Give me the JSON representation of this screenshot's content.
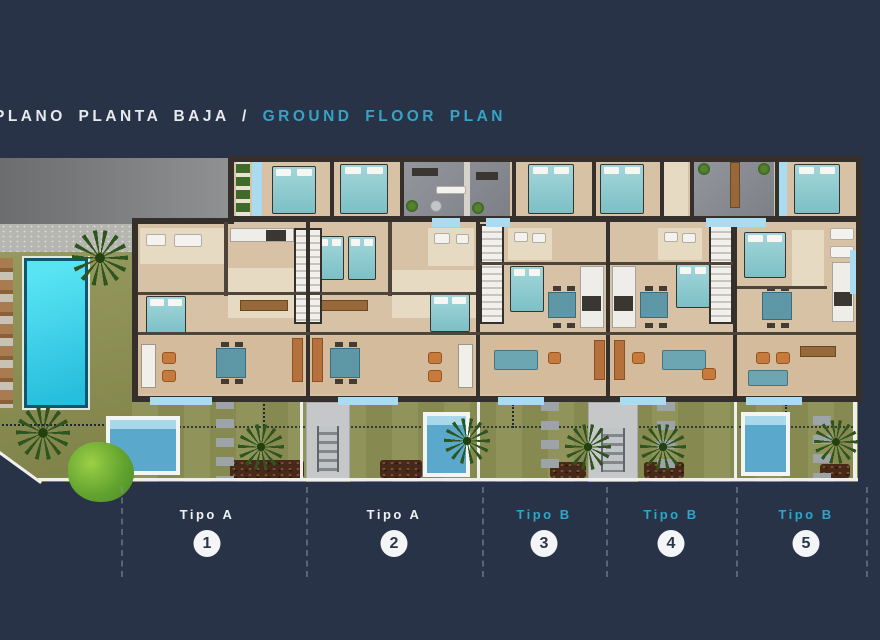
{
  "title": {
    "main": "PLANO PLANTA BAJA",
    "divider": "/",
    "sub": "GROUND FLOOR PLAN"
  },
  "units": [
    {
      "type_label": "Tipo A",
      "number": "1",
      "label_color": "#eef1f4",
      "private_pool": true
    },
    {
      "type_label": "Tipo A",
      "number": "2",
      "label_color": "#eef1f4",
      "private_pool": true
    },
    {
      "type_label": "Tipo B",
      "number": "3",
      "label_color": "#2ba7cb",
      "private_pool": false
    },
    {
      "type_label": "Tipo B",
      "number": "4",
      "label_color": "#2ba7cb",
      "private_pool": false
    },
    {
      "type_label": "Tipo B",
      "number": "5",
      "label_color": "#2ba7cb",
      "private_pool": true
    }
  ],
  "theme": {
    "background": "#293347",
    "accent_cyan": "#35a3c6",
    "title_color": "#e7eaee",
    "badge_background": "#f3f5f7",
    "badge_text": "#2b3548",
    "lawn_green": "#8d9055",
    "communal_pool_water": "#35cfe8",
    "plunge_pool_water": "#5aa9cd",
    "room_floor_beige": "#d8c2a6",
    "wall_dark": "#35302b",
    "road_gray": "#7d7e80",
    "terrace_gray": "#888b91"
  },
  "plan": {
    "type": "ground-floor residential site plan",
    "units_count": 5,
    "features": [
      "communal swimming pool",
      "sun loungers",
      "palm trees and shrubs",
      "private rear gardens with mulch beds",
      "private plunge pools at units 1, 2 and 5",
      "entry stair walkways between gardens",
      "gray terraces with plants and gym equipment",
      "street and sidewalk at top-left"
    ]
  }
}
